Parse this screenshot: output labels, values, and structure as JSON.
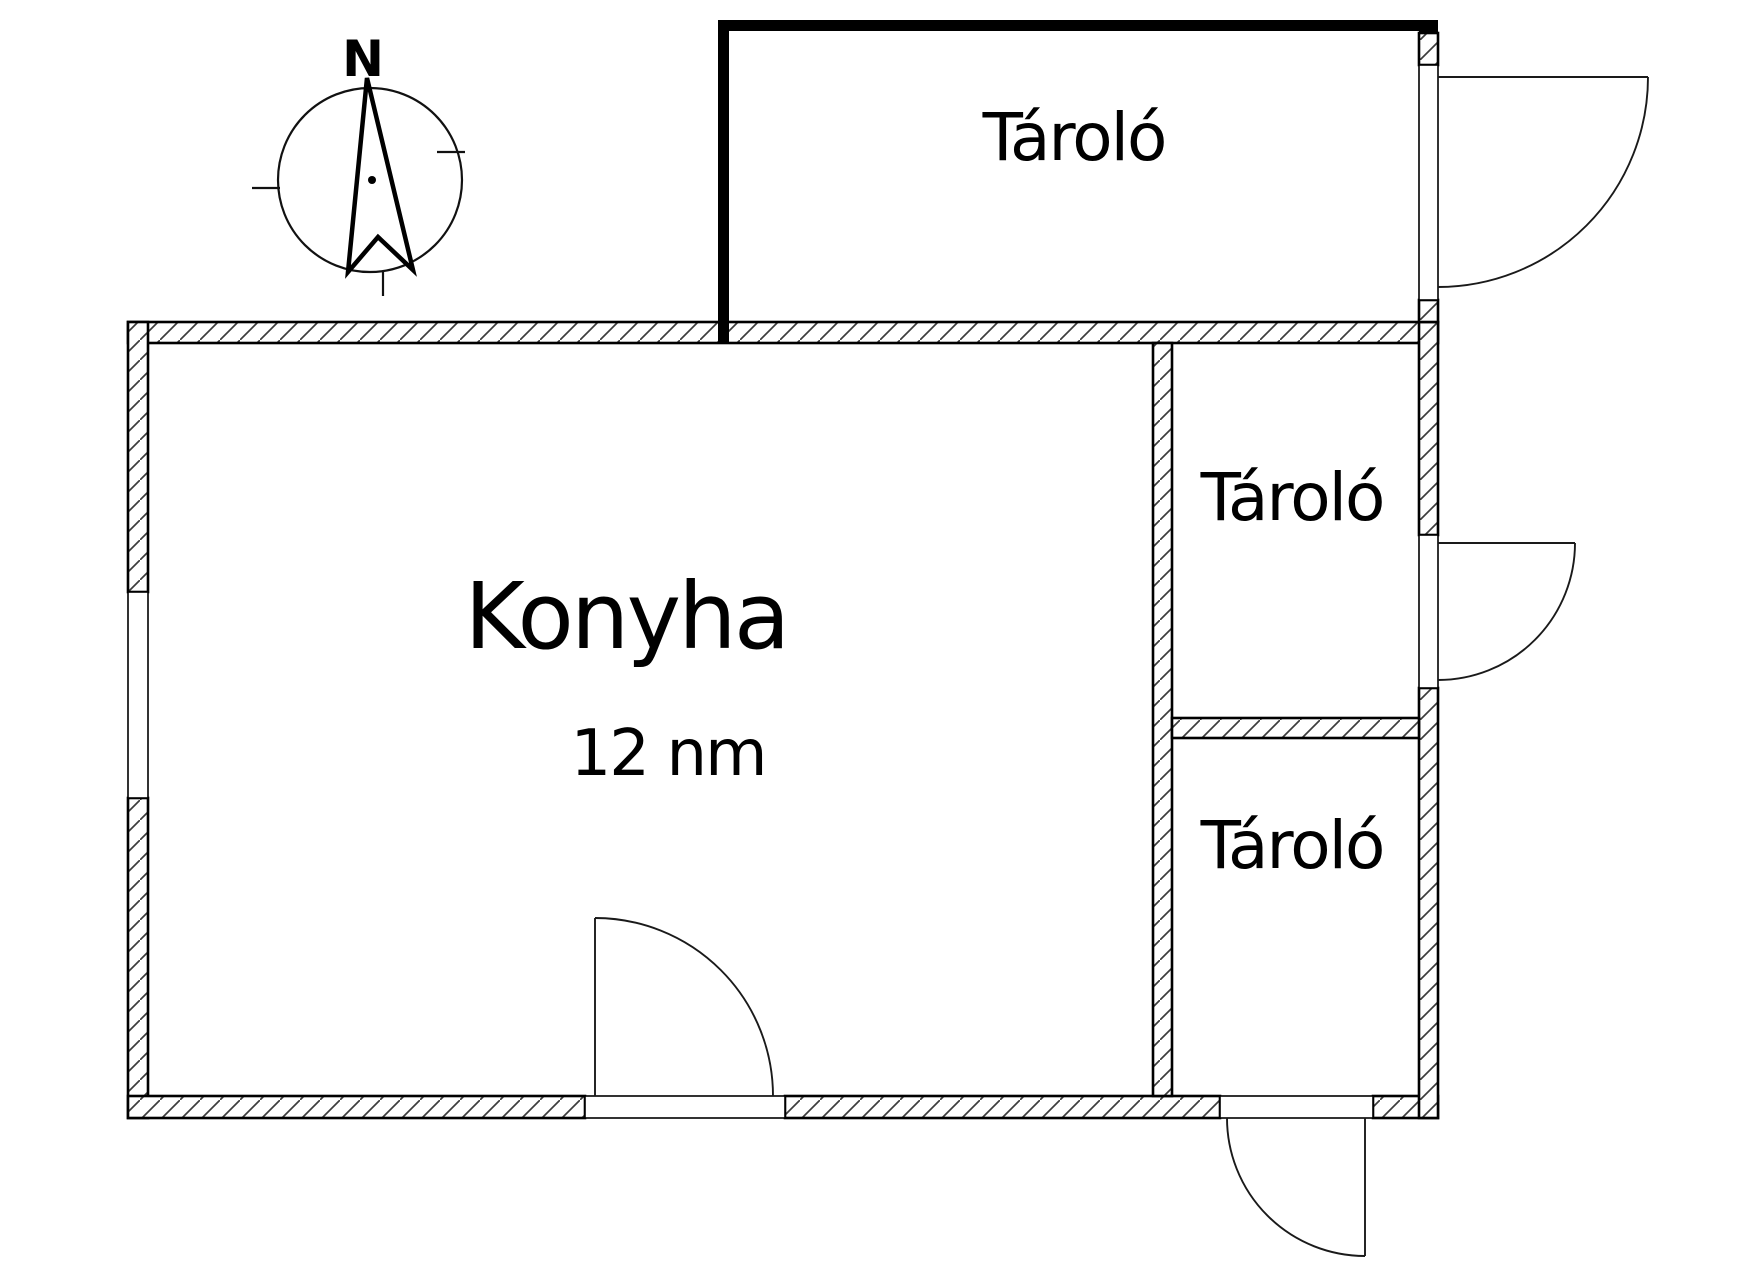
{
  "page": {
    "background_color": "#ffffff",
    "line_color": "#000000",
    "hatch_color": "#3d3d3d"
  },
  "compass": {
    "north_label": "N"
  },
  "rooms": {
    "storage_top": {
      "label": "Tároló"
    },
    "storage_middle": {
      "label": "Tároló"
    },
    "storage_bottom": {
      "label": "Tároló"
    },
    "kitchen": {
      "label": "Konyha",
      "area": "12 nm"
    }
  }
}
